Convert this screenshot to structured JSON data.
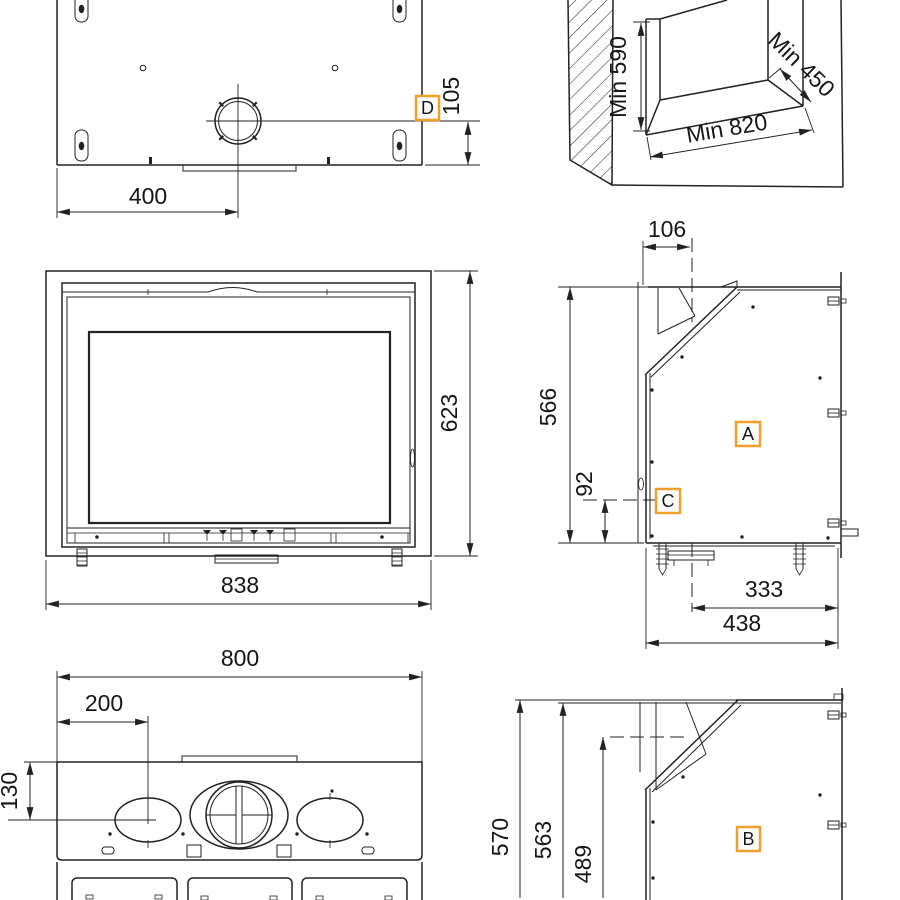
{
  "drawing": {
    "ink": "#222222",
    "accent": "#f0a02a",
    "views": {
      "flue_plan": {
        "dim_flue_center_x": "400",
        "dim_flue_center_y": "105",
        "marker_flue": "D"
      },
      "niche": {
        "dim_min_height": "Min 590",
        "dim_min_depth": "Min 450",
        "dim_min_width": "Min 820"
      },
      "front": {
        "dim_height": "623",
        "dim_width": "838"
      },
      "side_a": {
        "dim_flue_to_front": "106",
        "dim_body_height": "566",
        "dim_inlet_height": "92",
        "dim_flue_to_back": "333",
        "dim_depth": "438",
        "marker_body": "A",
        "marker_inlet": "C"
      },
      "top_plate": {
        "dim_width": "800",
        "dim_oval_offset_x": "200",
        "dim_oval_offset_y": "130"
      },
      "side_b": {
        "dim_overall_height": "570",
        "dim_top_height": "563",
        "dim_inlet_level": "489",
        "marker_body": "B"
      }
    }
  }
}
